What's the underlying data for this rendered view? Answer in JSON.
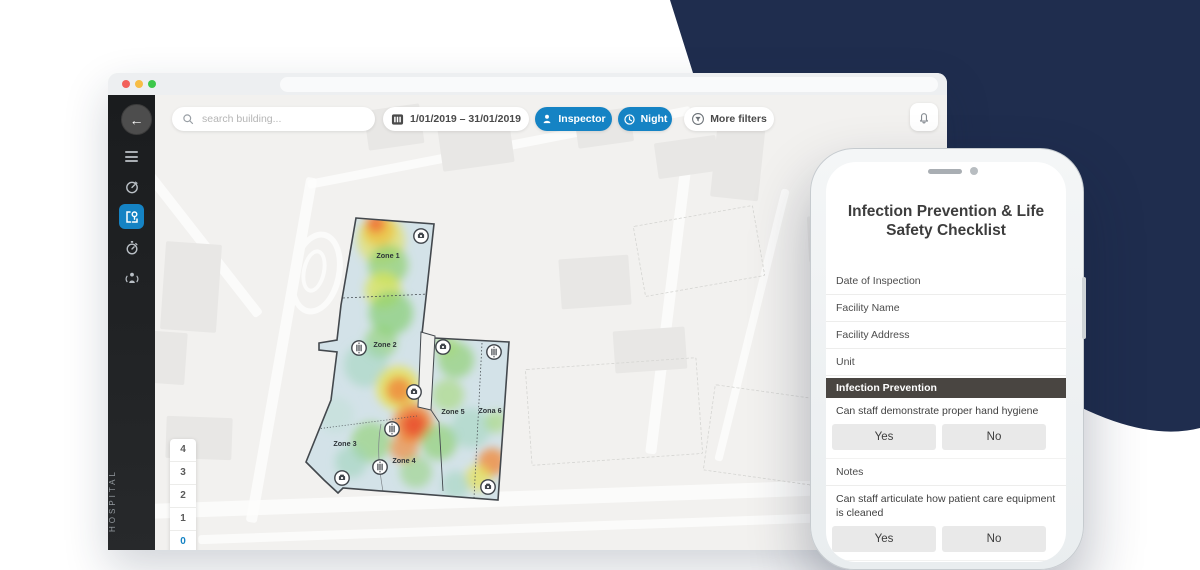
{
  "colors": {
    "accent": "#1583c4",
    "navy": "#1f2d4e",
    "section_header": "#494541",
    "building_base": "#d3e2e8",
    "traffic_lights": [
      "#f2605a",
      "#f7bd45",
      "#3dc84b"
    ]
  },
  "toolbar": {
    "search_placeholder": "search building...",
    "date_range": "1/01/2019 – 31/01/2019",
    "inspector_label": "Inspector",
    "night_label": "Night",
    "more_filters_label": "More filters"
  },
  "sidebar": {
    "vertical_label": "HOSPITAL",
    "icons": [
      {
        "name": "gauge-icon",
        "active": false
      },
      {
        "name": "floorplan-pin-icon",
        "active": true
      },
      {
        "name": "stopwatch-icon",
        "active": false
      },
      {
        "name": "occupancy-icon",
        "active": false
      }
    ]
  },
  "floor_selector": {
    "floors": [
      "4",
      "3",
      "2",
      "1",
      "0",
      "S1"
    ],
    "active": "0"
  },
  "map": {
    "zones": [
      {
        "label": "Zone 1",
        "x": 92,
        "y": 48
      },
      {
        "label": "Zone 2",
        "x": 89,
        "y": 137
      },
      {
        "label": "Zone 3",
        "x": 49,
        "y": 236
      },
      {
        "label": "Zone 4",
        "x": 108,
        "y": 253
      },
      {
        "label": "Zone 5",
        "x": 157,
        "y": 204
      },
      {
        "label": "Zona 6",
        "x": 194,
        "y": 203
      }
    ],
    "icons": [
      {
        "type": "camera",
        "x": 125,
        "y": 26
      },
      {
        "type": "camera",
        "x": 147,
        "y": 137
      },
      {
        "type": "camera",
        "x": 118,
        "y": 182
      },
      {
        "type": "camera",
        "x": 46,
        "y": 268
      },
      {
        "type": "camera",
        "x": 192,
        "y": 277
      },
      {
        "type": "sensor",
        "x": 63,
        "y": 138
      },
      {
        "type": "sensor",
        "x": 96,
        "y": 219
      },
      {
        "type": "sensor",
        "x": 84,
        "y": 257
      },
      {
        "type": "sensor",
        "x": 198,
        "y": 142
      }
    ],
    "heat": [
      {
        "x": 83,
        "y": 20,
        "r": 16,
        "c": "#f59a3c",
        "o": 0.85
      },
      {
        "x": 85,
        "y": 30,
        "r": 24,
        "c": "#e8e14e",
        "o": 0.6
      },
      {
        "x": 80,
        "y": 14,
        "r": 9,
        "c": "#ef6a38",
        "o": 0.8
      },
      {
        "x": 92,
        "y": 55,
        "r": 20,
        "c": "#8ed06e",
        "o": 0.7
      },
      {
        "x": 87,
        "y": 80,
        "r": 18,
        "c": "#d9e455",
        "o": 0.75
      },
      {
        "x": 95,
        "y": 103,
        "r": 22,
        "c": "#86cf74",
        "o": 0.7
      },
      {
        "x": 85,
        "y": 132,
        "r": 16,
        "c": "#8ed06e",
        "o": 0.6
      },
      {
        "x": 70,
        "y": 155,
        "r": 22,
        "c": "#9bd4b8",
        "o": 0.5
      },
      {
        "x": 102,
        "y": 178,
        "r": 22,
        "c": "#e8e14e",
        "o": 0.75
      },
      {
        "x": 103,
        "y": 180,
        "r": 13,
        "c": "#f08c3e",
        "o": 0.85
      },
      {
        "x": 117,
        "y": 213,
        "r": 20,
        "c": "#f08c3e",
        "o": 0.85
      },
      {
        "x": 118,
        "y": 215,
        "r": 12,
        "c": "#ea5430",
        "o": 0.9
      },
      {
        "x": 108,
        "y": 238,
        "r": 14,
        "c": "#f08c3e",
        "o": 0.7
      },
      {
        "x": 75,
        "y": 232,
        "r": 20,
        "c": "#8ed06e",
        "o": 0.6
      },
      {
        "x": 55,
        "y": 252,
        "r": 16,
        "c": "#9bd4b8",
        "o": 0.55
      },
      {
        "x": 40,
        "y": 205,
        "r": 18,
        "c": "#bfe0d6",
        "o": 0.5
      },
      {
        "x": 160,
        "y": 150,
        "r": 18,
        "c": "#8ed06e",
        "o": 0.65
      },
      {
        "x": 152,
        "y": 185,
        "r": 16,
        "c": "#a5d977",
        "o": 0.6
      },
      {
        "x": 150,
        "y": 135,
        "r": 12,
        "c": "#a5d977",
        "o": 0.6
      },
      {
        "x": 143,
        "y": 232,
        "r": 18,
        "c": "#8ed06e",
        "o": 0.65
      },
      {
        "x": 175,
        "y": 218,
        "r": 20,
        "c": "#9bd4b8",
        "o": 0.5
      },
      {
        "x": 196,
        "y": 252,
        "r": 14,
        "c": "#f08c3e",
        "o": 0.8
      },
      {
        "x": 182,
        "y": 268,
        "r": 13,
        "c": "#e8e14e",
        "o": 0.7
      },
      {
        "x": 200,
        "y": 212,
        "r": 11,
        "c": "#a5d977",
        "o": 0.6
      },
      {
        "x": 120,
        "y": 262,
        "r": 16,
        "c": "#8ed06e",
        "o": 0.5
      },
      {
        "x": 160,
        "y": 275,
        "r": 14,
        "c": "#9bd4b8",
        "o": 0.5
      }
    ]
  },
  "phone": {
    "title": "Infection Prevention & Life Safety Checklist",
    "yes_label": "Yes",
    "no_label": "No",
    "rows": [
      {
        "type": "field",
        "label": "Date of Inspection"
      },
      {
        "type": "field",
        "label": "Facility Name"
      },
      {
        "type": "field",
        "label": "Facility Address"
      },
      {
        "type": "field",
        "label": "Unit"
      },
      {
        "type": "section",
        "label": "Infection Prevention"
      },
      {
        "type": "question",
        "label": "Can staff demonstrate proper hand hygiene"
      },
      {
        "type": "field",
        "label": "Notes"
      },
      {
        "type": "question",
        "label": "Can staff articulate how patient care equipment is cleaned"
      }
    ]
  }
}
